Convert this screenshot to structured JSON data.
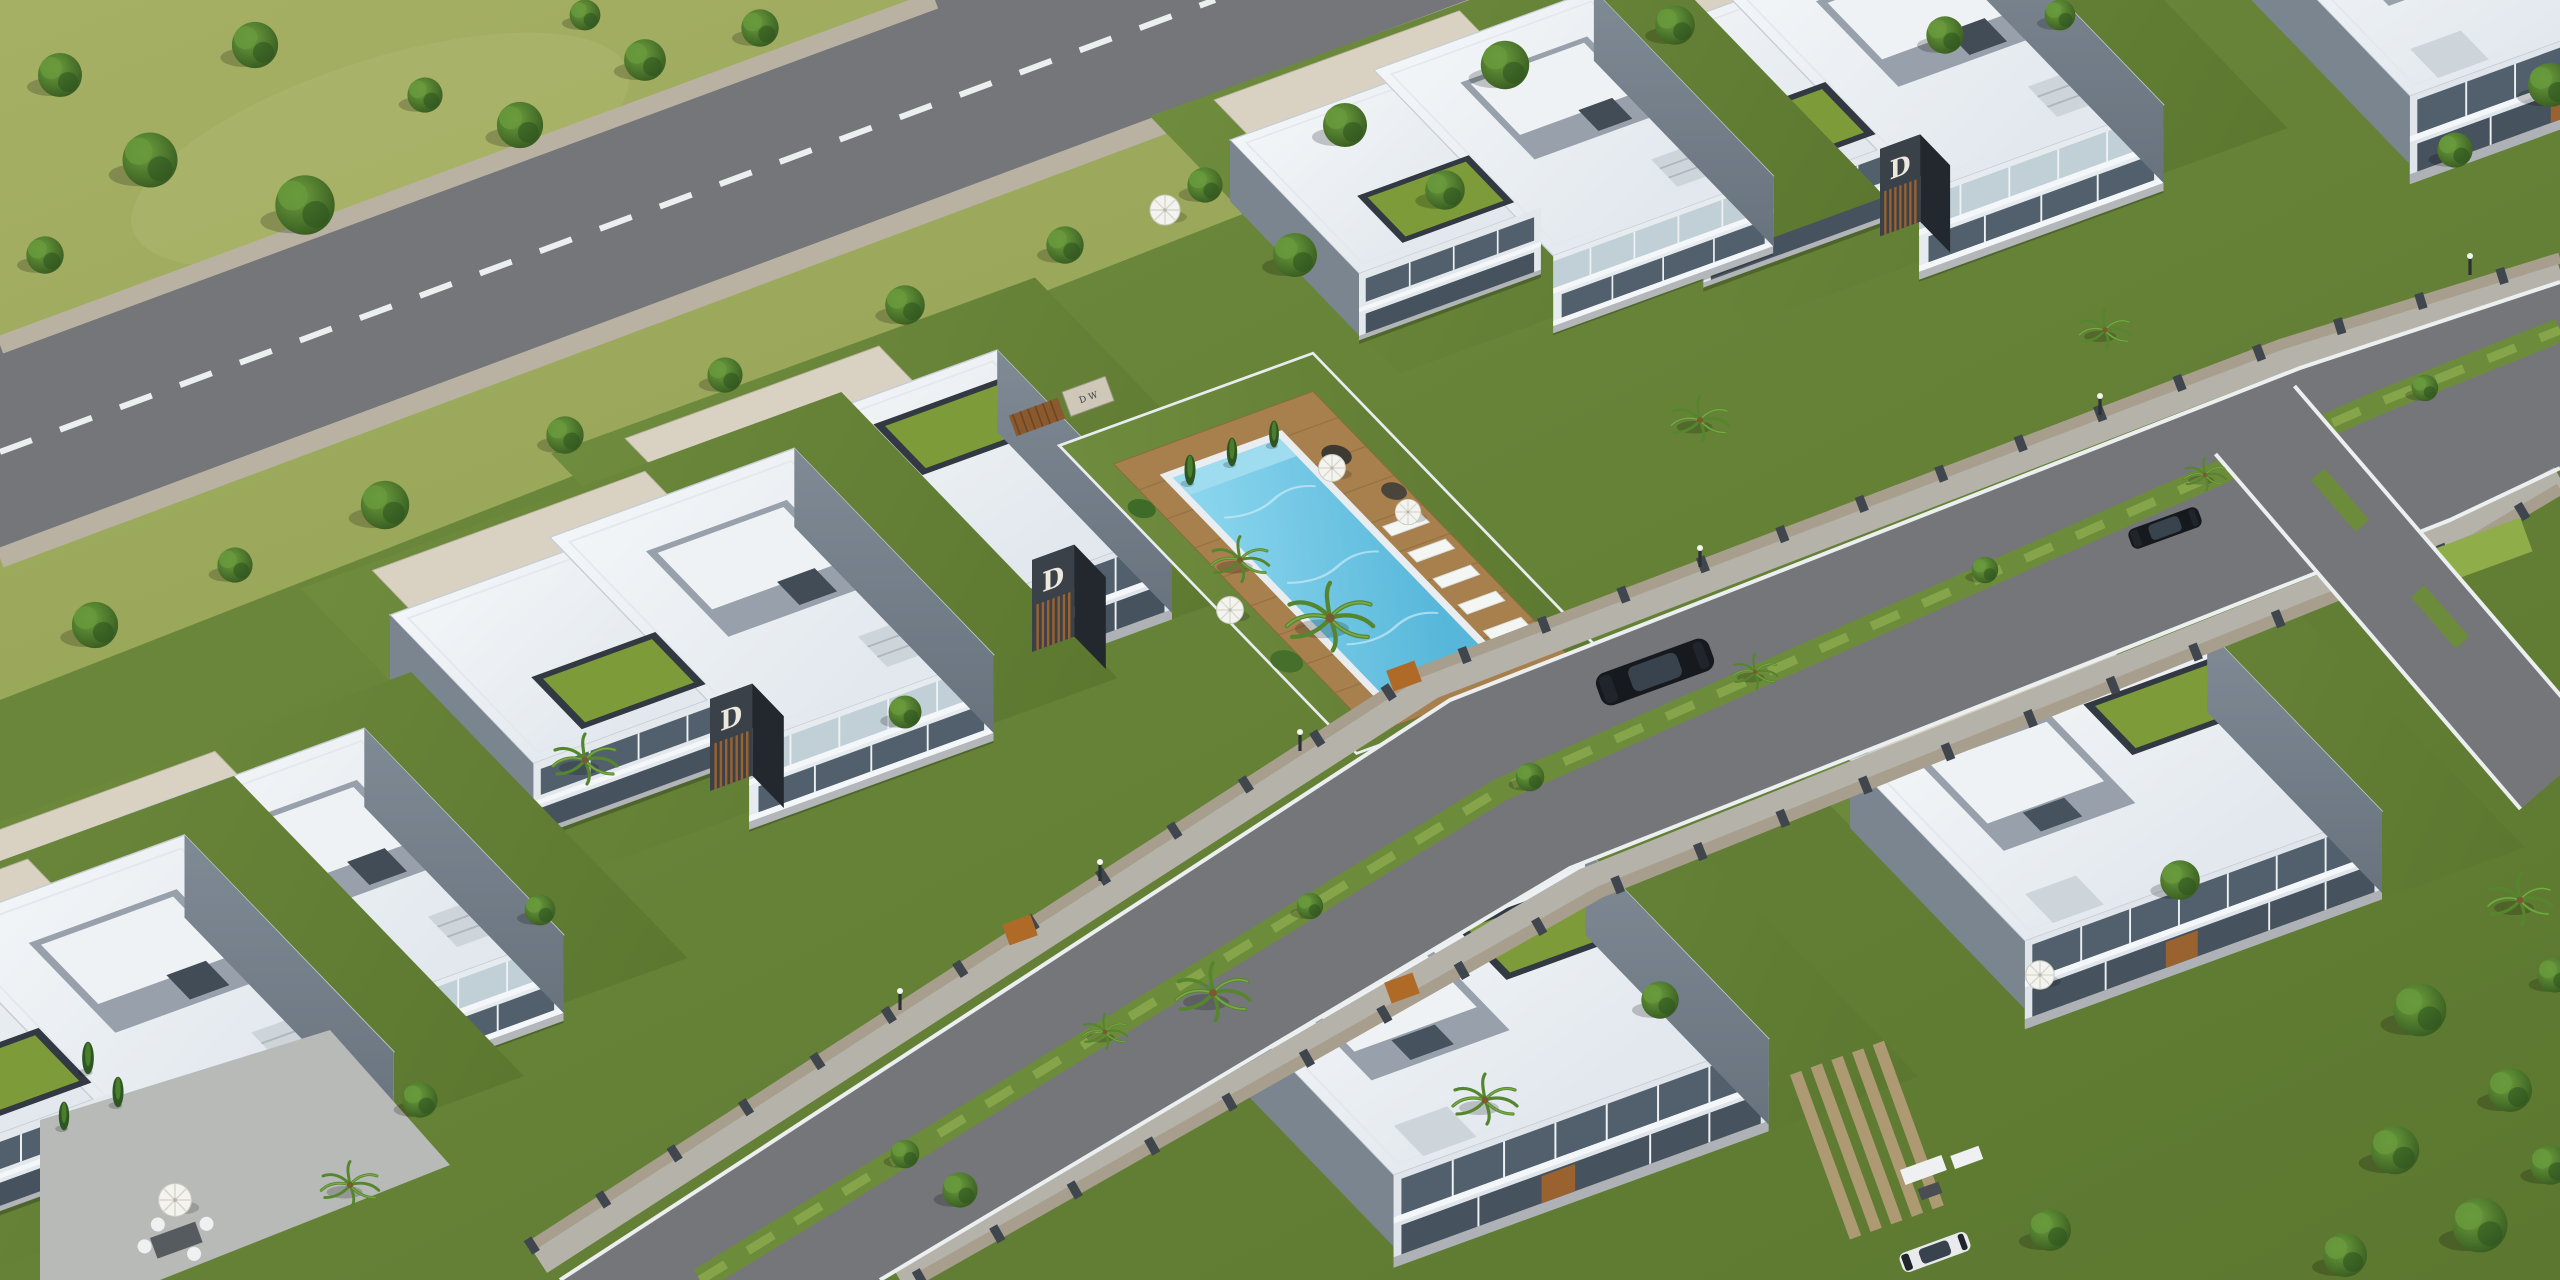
{
  "scene": {
    "description": "Aerial 3D architectural rendering of a modern villa estate: two rows of flat-roofed white and grey villas with charcoal wood-slat corner towers, landscaped gardens, a shared swimming pool with timber deck, sun loungers and parasols, tree-lined streets with stone boundary walls and gates, parked cars, and open green fields along the upper road.",
    "branding": {
      "logo_letter": "D",
      "entrance_sign_text": "D W"
    }
  },
  "palette": {
    "grass_field_a": "#a6b065",
    "grass_field_b": "#8fa050",
    "garden_a": "#6f8c3e",
    "garden_b": "#5c7830",
    "tree_a": "#6da13e",
    "tree_b": "#35571f",
    "asphalt": "#74767a",
    "cobble": "#b9b2a3",
    "roof_white": "#f3f6f8",
    "roof_beige": "#d9d2c3",
    "wall_grey": "#8d97a1",
    "slate_dark": "#3a4149",
    "glass": "#51606c",
    "wood": "#99622f",
    "green_roof": "#7d9c39",
    "pool_a": "#8fd8ef",
    "pool_b": "#57b7da",
    "stone_wall": "#a79e8e",
    "curb_white": "#eceff0"
  }
}
